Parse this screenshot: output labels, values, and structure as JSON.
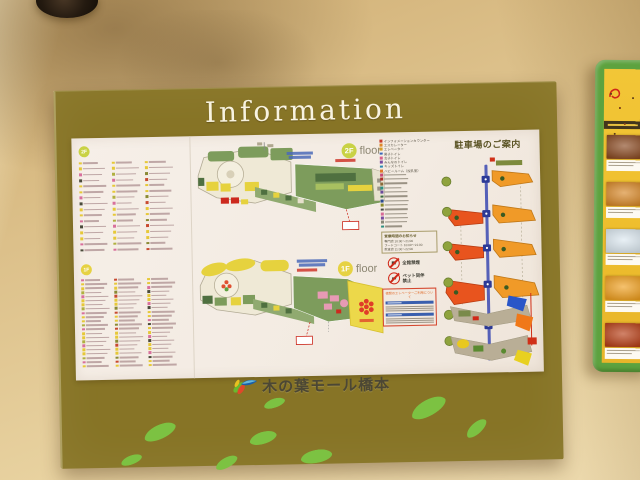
{
  "colors": {
    "board_olive": "#877426",
    "title_white": "#f8f3e0",
    "badge_2f": "#c9d245",
    "badge_1f": "#e6d243",
    "legend_text": "#5a5446",
    "hours_border": "#a89c6a",
    "notice_red": "#d5472e",
    "notice_blue": "#3a5fae",
    "map_green": "#7d9c5c",
    "map_dark_green": "#4f7040",
    "map_yellow": "#e6d23e",
    "map_cream": "#efe9d6",
    "map_outline": "#b2ab95",
    "map_red": "#cc2a1e",
    "map_pink": "#e79ab4",
    "map_blue": "#4a6ab8",
    "sunlive_yellow": "#ecd84a",
    "sunlive_red": "#e03c28",
    "parking_orange": "#f09a28",
    "parking_red": "#e8541e",
    "road_blue": "#5560b8",
    "lot_gray": "#b9ae96",
    "pk_green_badge": "#8fa33d",
    "frame_green": "#5da23f",
    "poster_yellow": "#efbf2e",
    "poster_header": "#43361c",
    "leaf_green": "#7cc242",
    "logo_text": "#4c4734"
  },
  "sign": {
    "title": "Information",
    "logo_text": "木の葉モール橋本"
  },
  "floors": [
    {
      "badge": "2F",
      "label": "floor"
    },
    {
      "badge": "1F",
      "label": "floor"
    }
  ],
  "directory": {
    "bullet_palette": [
      "#e6c838",
      "#e6c838",
      "#d8709c",
      "#e6c838",
      "#8a8a34",
      "#e6c838",
      "#d8709c",
      "#c84a30",
      "#e6c838",
      "#4a4a3a",
      "#e6c838",
      "#b0b040"
    ],
    "sections": [
      {
        "badge": "2F",
        "columns": [
          16,
          16,
          16
        ]
      },
      {
        "badge": "1F",
        "columns": [
          22,
          22,
          22
        ]
      }
    ]
  },
  "legend": {
    "items": [
      {
        "color": "#c83a28",
        "label": "インフォメーションカウンター"
      },
      {
        "color": "#e08828",
        "label": "エスカレーター"
      },
      {
        "color": "#d8a028",
        "label": "エレベーター"
      },
      {
        "color": "#3a66b8",
        "label": "男子トイレ"
      },
      {
        "color": "#d8608a",
        "label": "女子トイレ"
      },
      {
        "color": "#7a4ba0",
        "label": "みんなのトイレ"
      },
      {
        "color": "#2a8ab0",
        "label": "キッズトイレ"
      },
      {
        "color": "#e07828",
        "label": "ベビールーム（授乳室）"
      },
      {
        "color": "#c84878",
        "label": ""
      },
      {
        "color": "#b03028",
        "label": ""
      },
      {
        "color": "#8a6a3a",
        "label": ""
      },
      {
        "color": "#2e8f80",
        "label": ""
      },
      {
        "color": "#6a4a9a",
        "label": ""
      },
      {
        "color": "#3a6a40",
        "label": ""
      },
      {
        "color": "#2b4a8f",
        "label": ""
      },
      {
        "color": "#8a8a2a",
        "label": ""
      },
      {
        "color": "#4a4a48",
        "label": ""
      },
      {
        "color": "#d86a98",
        "label": ""
      },
      {
        "color": "#7a4ba0",
        "label": ""
      },
      {
        "color": "#888878",
        "label": ""
      },
      {
        "color": "#2e8f80",
        "label": ""
      }
    ]
  },
  "hours": {
    "title": "営業時間のお知らせ",
    "rows": [
      "専門店 10:00〜21:00",
      "フードコート 10:00〜21:00",
      "飲食店 11:00〜22:00"
    ]
  },
  "rules": [
    {
      "label": "全館禁煙"
    },
    {
      "label": "ペット同伴禁止"
    }
  ],
  "notice": {
    "title": "夜間のエレベーターご利用について"
  },
  "parking": {
    "title": "駐車場のご案内"
  },
  "leaves": [
    {
      "x": 83,
      "y": 336,
      "w": 34,
      "h": 14,
      "r": -24
    },
    {
      "x": 204,
      "y": 312,
      "w": 22,
      "h": 9,
      "r": -18
    },
    {
      "x": 189,
      "y": 345,
      "w": 28,
      "h": 12,
      "r": -16
    },
    {
      "x": 240,
      "y": 364,
      "w": 32,
      "h": 13,
      "r": -10
    },
    {
      "x": 154,
      "y": 370,
      "w": 24,
      "h": 10,
      "r": -28
    },
    {
      "x": 350,
      "y": 316,
      "w": 38,
      "h": 16,
      "r": -28
    },
    {
      "x": 404,
      "y": 340,
      "w": 25,
      "h": 11,
      "r": -42
    },
    {
      "x": 60,
      "y": 366,
      "w": 22,
      "h": 9,
      "r": -20
    }
  ],
  "menu_board": {
    "cards": [
      "#8a4a22",
      "#d88828",
      "#dce8f0",
      "#f0a020",
      "#b84018",
      "#e8d0a0"
    ]
  }
}
